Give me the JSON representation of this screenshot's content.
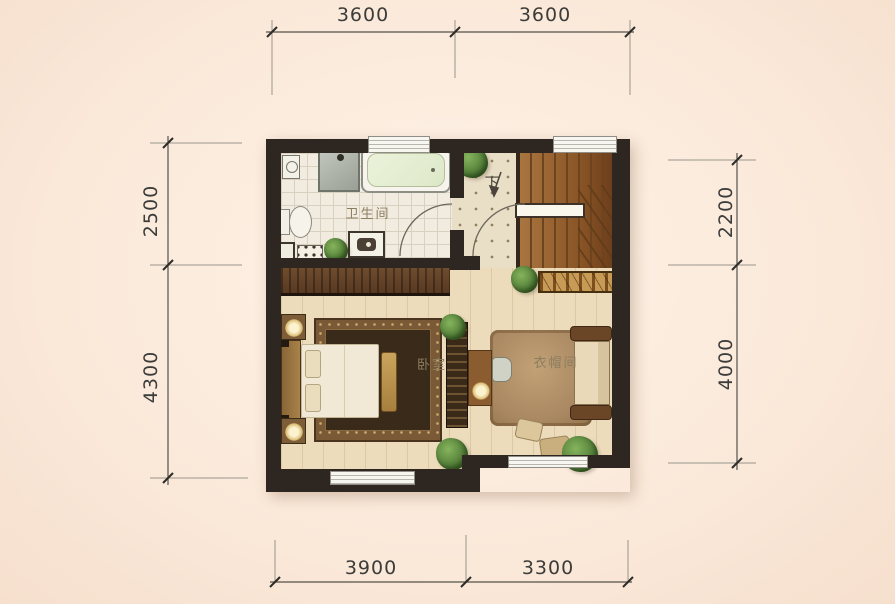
{
  "plan": {
    "rooms": {
      "bathroom": "卫生间",
      "bedroom": "卧室",
      "cloakroom": "衣帽间",
      "stairs_down": "下"
    },
    "dimensions": {
      "top": [
        "3600",
        "3600"
      ],
      "bottom": [
        "3900",
        "3300"
      ],
      "left": [
        "2500",
        "4300"
      ],
      "right": [
        "2200",
        "4000"
      ]
    },
    "colors": {
      "background": "#fbeadb",
      "wall": "#2e2721",
      "wood_floor": "#ecdcbc",
      "stair_wood": "#8a5526",
      "bath_tile": "#f1ecdf",
      "dimension_text": "#3c3c3a"
    }
  }
}
